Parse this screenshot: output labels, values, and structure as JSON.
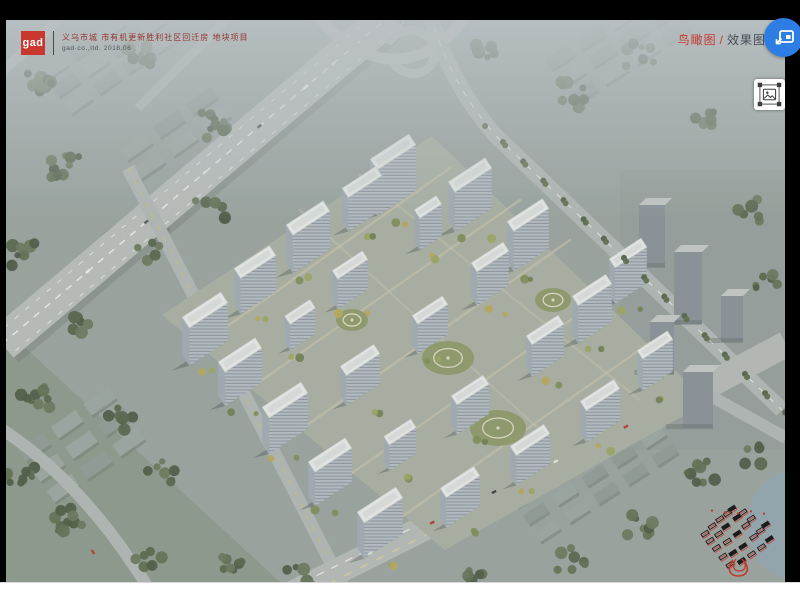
{
  "title_block": {
    "logo_text": "gad",
    "project_title": "义乌市城 市有机更新胜利社区回迁房 地块项目",
    "project_subtitle": "gad·co.,ltd.  2018.06"
  },
  "view_label": {
    "primary": "鸟瞰图",
    "separator": "/",
    "secondary": "效果图"
  },
  "overlay_buttons": {
    "float_window_icon": "picture-in-picture-icon",
    "image_capture_icon": "image-select-icon"
  },
  "colors": {
    "logo_red": "#c8382e",
    "label_red": "#c23b31",
    "float_button_blue": "#2e7de5",
    "keymap_red": "#b23a32",
    "letterbox_black": "#000000",
    "bottom_bar_white": "#ffffff"
  }
}
